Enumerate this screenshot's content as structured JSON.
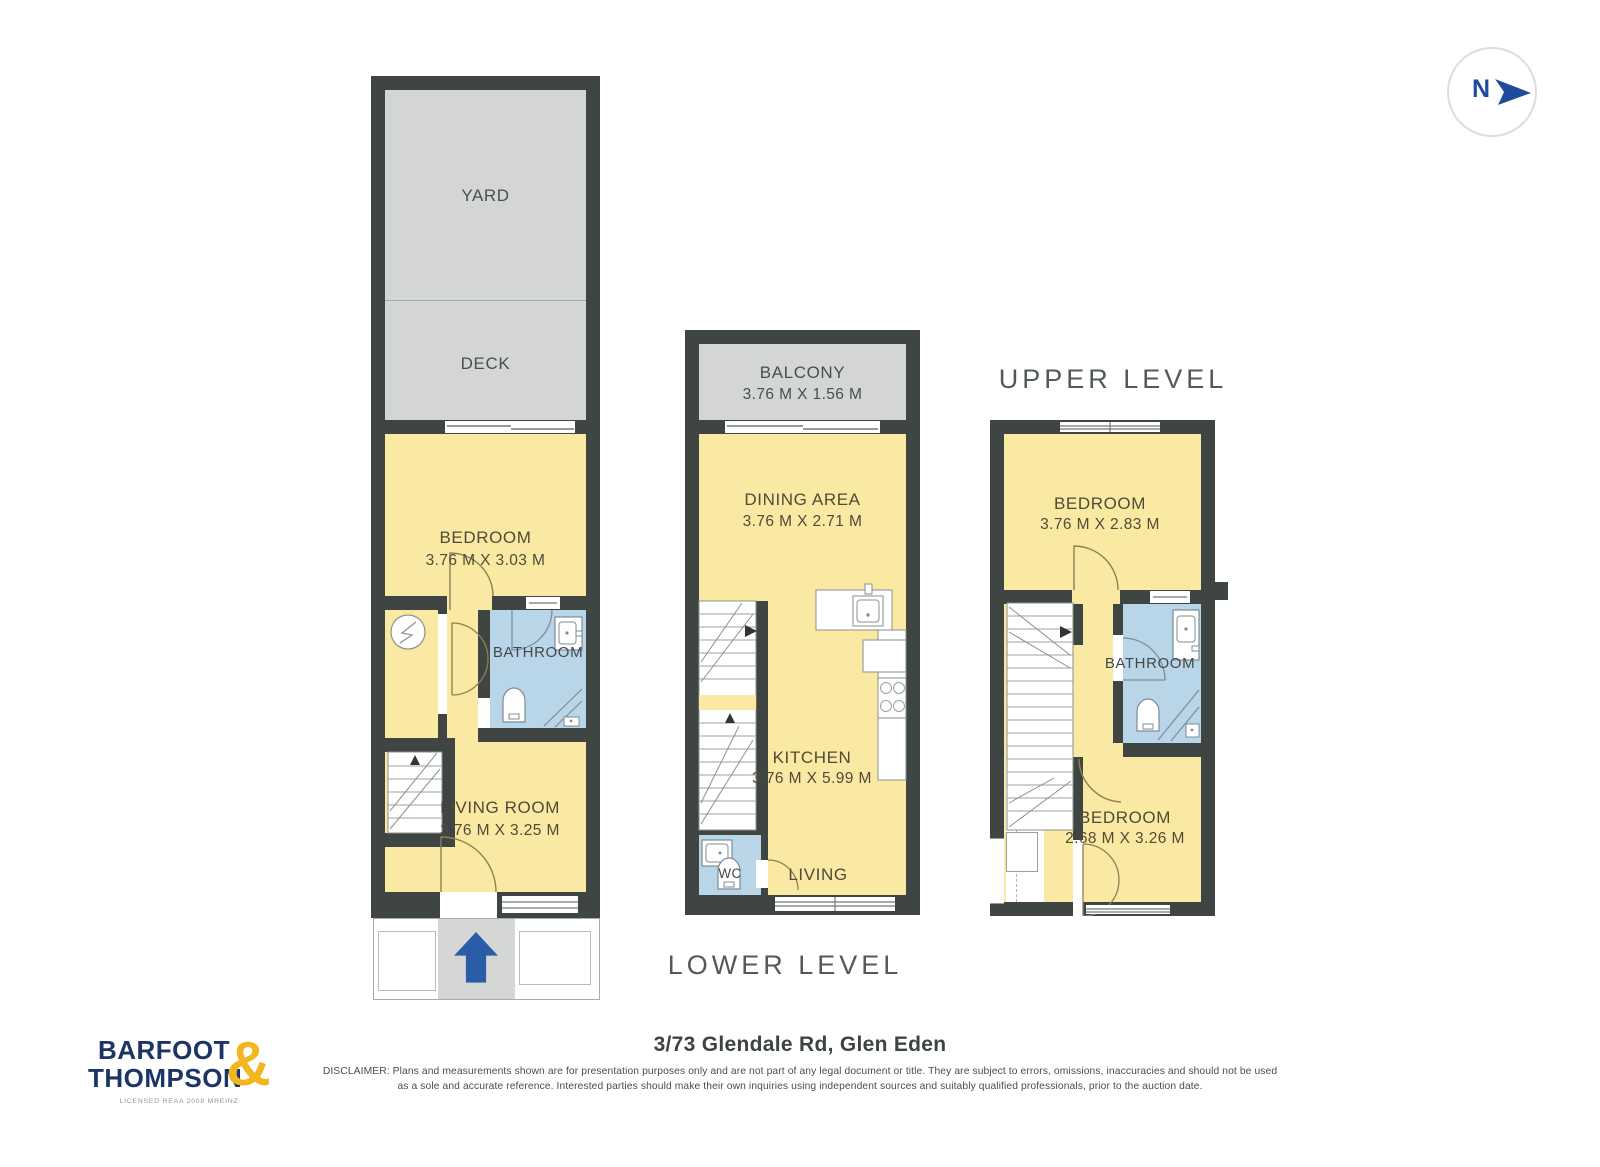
{
  "compass": {
    "label": "N"
  },
  "plans": {
    "ground": {
      "yard_label": "YARD",
      "deck_label": "DECK",
      "bedroom_label": "BEDROOM",
      "bedroom_dims": "3.76 M X 3.03 M",
      "bathroom_label": "BATHROOM",
      "living_label": "LIVING ROOM",
      "living_dims": "3.76 M X 3.25 M"
    },
    "lower": {
      "title": "LOWER LEVEL",
      "balcony_label": "BALCONY",
      "balcony_dims": "3.76 M X 1.56 M",
      "dining_label": "DINING AREA",
      "dining_dims": "3.76 M X 2.71 M",
      "kitchen_label": "KITCHEN",
      "kitchen_dims": "3.76 M X 5.99 M",
      "wc_label": "WC",
      "living_label": "LIVING"
    },
    "upper": {
      "title": "UPPER LEVEL",
      "bedroom1_label": "BEDROOM",
      "bedroom1_dims": "3.76 M X 2.83 M",
      "bathroom_label": "BATHROOM",
      "bedroom2_label": "BEDROOM",
      "bedroom2_dims": "2.68 M X 3.26 M"
    }
  },
  "footer": {
    "logo_line1": "BARFOOT",
    "logo_line2": "THOMPSON",
    "logo_ampersand": "&",
    "logo_tagline": "LICENSED REAA 2008 MREINZ",
    "address": "3/73 Glendale Rd, Glen Eden",
    "disclaimer_line1": "DISCLAIMER: Plans and measurements shown are for presentation purposes only and are not part of any legal document or title. They are subject to errors, omissions, inaccuracies and should not be used",
    "disclaimer_line2": "as a sole and accurate reference. Interested parties should make their own inquiries using independent sources and suitably qualified professionals, prior to the auction date."
  },
  "colors": {
    "wall": "#3F4543",
    "floor_yellow": "#F9E9A2",
    "outdoor_gray": "#D3D6D4",
    "bathroom_blue": "#B9D6E9",
    "brand_navy": "#1C3565",
    "brand_gold": "#F2B71E",
    "entry_arrow_blue": "#2A5CA8"
  }
}
